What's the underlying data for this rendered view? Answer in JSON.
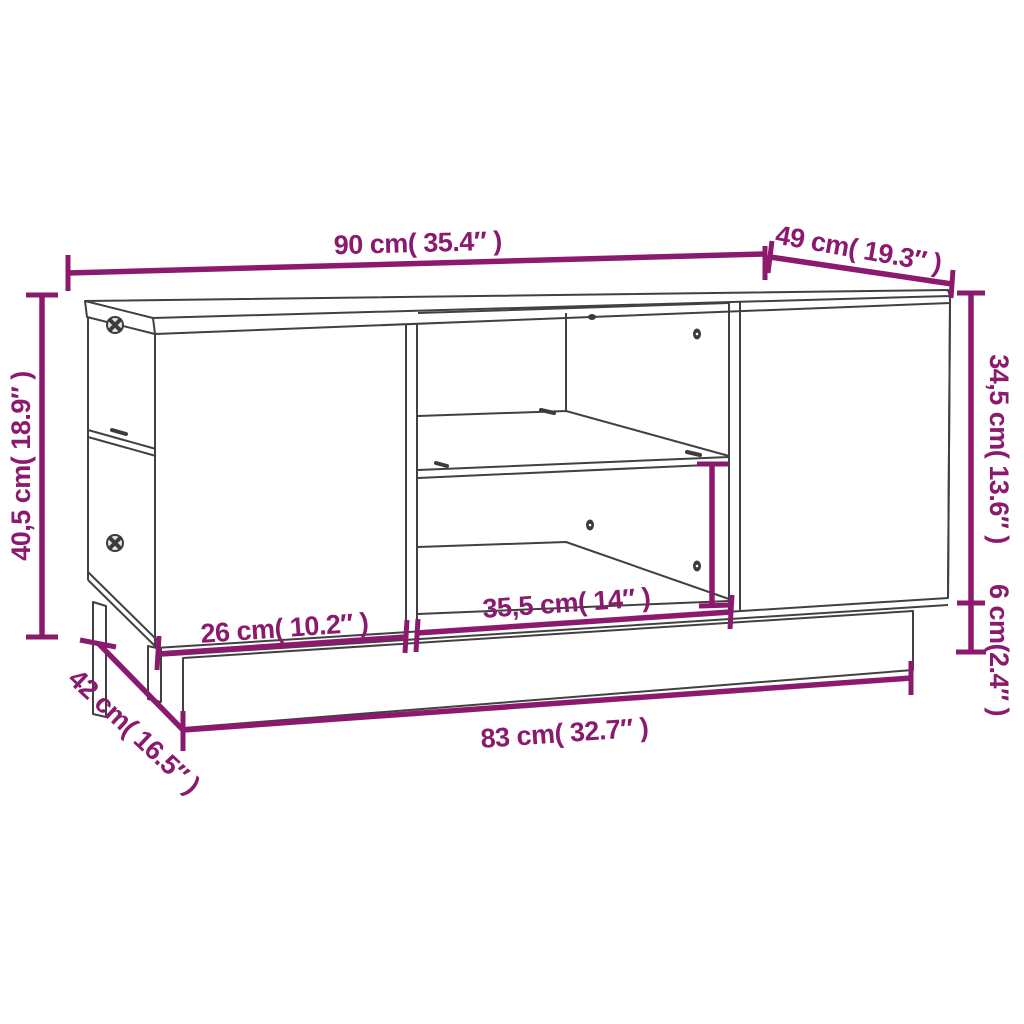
{
  "diagram": {
    "type": "furniture-dimension-diagram",
    "subject": "coffee table line drawing with open compartments, shelf and plinth base",
    "accent_color": "#8b1a6e",
    "outline_color": "#414141",
    "background_color": "#ffffff",
    "dimensions": {
      "top_width": {
        "label": "90 cm( 35.4″ )"
      },
      "top_depth": {
        "label": "49 cm( 19.3″ )"
      },
      "left_height": {
        "label": "40,5 cm( 18.9″ )"
      },
      "right_upper_height": {
        "label": "34,5 cm( 13.6″ )"
      },
      "right_base_height": {
        "label": "6 cm(2.4″ )"
      },
      "left_door_width": {
        "label": "26 cm( 10.2″ )"
      },
      "middle_compartment_width": {
        "label": "35,5 cm( 14″ )"
      },
      "base_depth": {
        "label": "42 cm( 16.5″ )"
      },
      "base_width": {
        "label": "83 cm( 32.7″ )"
      }
    }
  }
}
